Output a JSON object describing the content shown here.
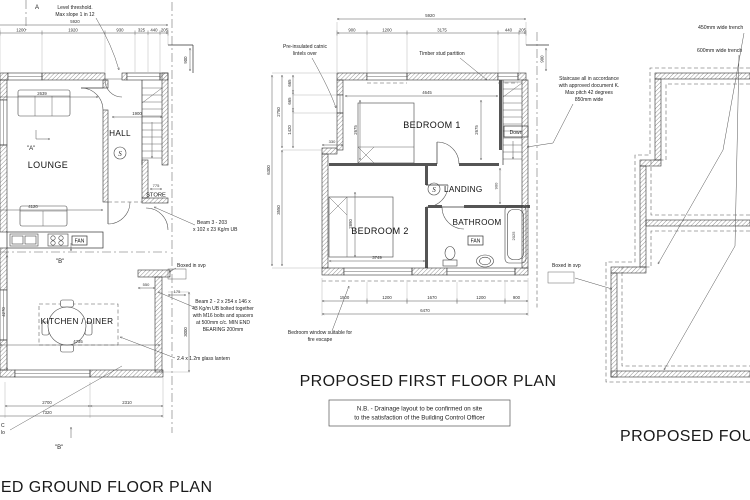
{
  "ground": {
    "title": "PROPOSED GROUND FLOOR PLAN",
    "rooms": {
      "lounge": "LOUNGE",
      "hall": "HALL",
      "store": "STORE",
      "kitchen": "KITCHEN / DINER",
      "fan": "FAN"
    },
    "smoke": "S",
    "sections": {
      "a_top": "A",
      "a_mid": "\"A\"",
      "b_mid": "\"B\"",
      "b_bottom": "\"B\""
    },
    "annotations": {
      "level_threshold": [
        "Level threshold.",
        "Max slope 1 in 12"
      ],
      "beam3": [
        "Beam 3 - 203",
        "x 102 x 23 Kg/m UB"
      ],
      "boxed_svp": "Boxed in svp",
      "beam2": [
        "Beam 2 - 2 x 254 x 146 x",
        "43 Kg/m UB bolted together",
        "with M16 bolts and spacers",
        "at 500mm c/c. MIN END",
        "BEARING 200mm"
      ],
      "glass_lantern": "2.4 x 1.2m glass lantern"
    },
    "edge_fragments": [
      "C",
      "lo"
    ],
    "dims": {
      "overall_top": "5920",
      "top": [
        "1200",
        "1920",
        "930",
        "325",
        "440",
        "205"
      ],
      "right_stub": "900",
      "hall": "1900",
      "lounge_upper": "2639",
      "lounge_lower": "4120",
      "store": "775",
      "left": "4270",
      "kitchen": "4735",
      "step": "550",
      "svp": "175",
      "right_lower": "3000",
      "bottom": [
        "2700",
        "2310"
      ],
      "overall_bottom": "7320"
    }
  },
  "first": {
    "title": "PROPOSED FIRST FLOOR PLAN",
    "rooms": {
      "bedroom1": "BEDROOM 1",
      "bedroom2": "BEDROOM 2",
      "landing": "LANDING",
      "bathroom": "BATHROOM",
      "fan": "FAN"
    },
    "smoke": "S",
    "stairs": "Down",
    "annotations": {
      "catnic": [
        "Pre-insulated catnic",
        "lintels over"
      ],
      "stud": "Timber stud partition",
      "staircase": [
        "Staircase all in accordance",
        "with approved document K.",
        "Max pitch 42 degrees",
        "850mm wide"
      ],
      "fire_escape": [
        "Bedroom window suitable for",
        "fire escape"
      ]
    },
    "note": [
      "N.B. - Drainage layout to be confirmed on site",
      "to the satisfaction of the Building Control Officer"
    ],
    "dims": {
      "overall_top": "5920",
      "top": [
        "900",
        "1200",
        "3175",
        "440",
        "205"
      ],
      "right_stub": "900",
      "left_total": "6300",
      "left_upper": "2750",
      "left_lower": "3550",
      "left_inner": [
        "665",
        "665",
        "1420"
      ],
      "bed1_width": "4645",
      "bed1_left": "2675",
      "bed1_right": "2675",
      "step": "330",
      "bed2_height": "2890",
      "bed2_width": "3749",
      "landing": "900",
      "bath": "2025",
      "bottom": [
        "1500",
        "1200",
        "1670",
        "1200",
        "900"
      ],
      "overall_bottom": "6470"
    }
  },
  "foundation": {
    "title": "PROPOSED FOUNDATION PLAN",
    "annotations": {
      "trench450": "450mm wide trench",
      "trench600": "600mm wide trench",
      "boxed_svp": "Boxed in svp"
    }
  }
}
